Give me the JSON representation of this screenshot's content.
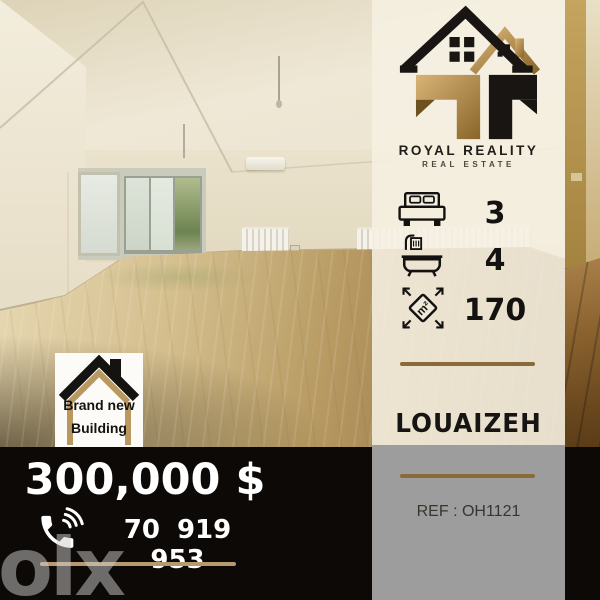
{
  "branding": {
    "name": "ROYAL REALITY",
    "tagline": "REAL ESTATE"
  },
  "features": {
    "bedrooms": "3",
    "bathrooms": "4",
    "area": "170",
    "area_unit": "m²"
  },
  "location": "LOUAIZEH",
  "reference": "REF : OH1121",
  "badge": {
    "line1": "Brand new",
    "line2": "Building"
  },
  "price": "300,000 $",
  "phone": "70 919 953",
  "watermark": "olx",
  "icons": {
    "logo": "twin-house-logo",
    "bedrooms": "bed-icon",
    "bathrooms": "bathtub-shower-icon",
    "area": "area-m2-diamond-icon",
    "phone": "phone-handset-icon",
    "badge": "house-outline-icon"
  },
  "colors": {
    "accent_gold": "#8a6a38",
    "logo_gold": "#c7a266",
    "panel_cream": "#f2ebda",
    "panel_gray": "#9d9d9d",
    "bar_black": "#0c0906",
    "text_dark": "#171513",
    "text_white": "#ffffff",
    "underline_tan": "#b69a6f"
  }
}
